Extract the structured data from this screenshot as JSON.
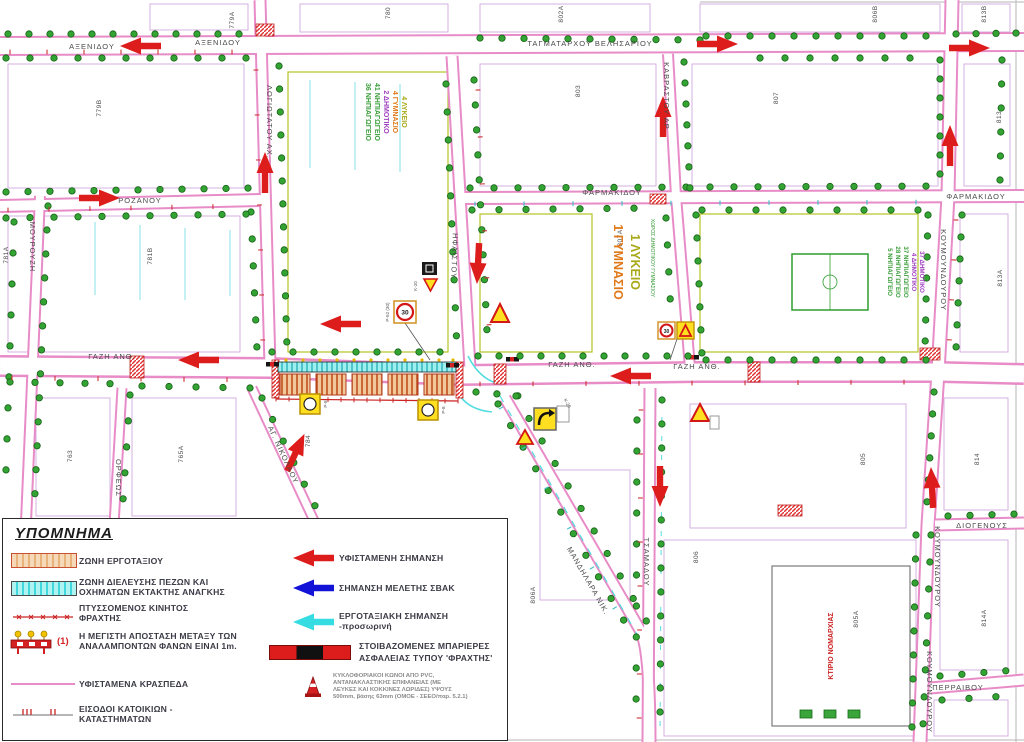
{
  "legend": {
    "title": "ΥΠΟΜΝΗΜΑ",
    "left": [
      {
        "lines": [
          "ΖΩΝΗ  ΕΡΓΟΤΑΞΙΟΥ"
        ]
      },
      {
        "lines": [
          "ΖΩΝΗ  ΔΙΕΛΕΥΣΗΣ ΠΕΖΩΝ ΚΑΙ",
          "ΟΧΗΜΑΤΩΝ ΕΚΤΑΚΤΗΣ ΑΝΑΓΚΗΣ"
        ]
      },
      {
        "lines": [
          "ΠΤΥΣΣΟΜΕΝΟΣ ΚΙΝΗΤΟΣ",
          "ΦΡΑΧΤΗΣ"
        ]
      },
      {
        "prefix": "(1)",
        "lines": [
          "Η ΜΕΓΙΣΤΗ ΑΠΟΣΤΑΣΗ ΜΕΤΑΞΥ ΤΩΝ",
          "ΑΝΑΛΑΜΠΟΝΤΩΝ ΦΑΝΩΝ ΕΙΝΑΙ 1m."
        ]
      },
      {
        "lines": [
          "ΥΦΙΣΤΑΜΕΝΑ ΚΡΑΣΠΕΔΑ"
        ]
      },
      {
        "lines": [
          "ΕΙΣΟΔΟΙ ΚΑΤΟΙΚΙΩΝ -",
          "ΚΑΤΑΣΤΗΜΑΤΩΝ"
        ]
      }
    ],
    "right": [
      {
        "lines": [
          "ΥΦΙΣΤΑΜΕΝΗ ΣΗΜΑΝΣΗ"
        ]
      },
      {
        "lines": [
          "ΣΗΜΑΝΣΗ ΜΕΛΕΤΗΣ ΣΒΑΚ"
        ]
      },
      {
        "lines": [
          "ΕΡΓΟΤΑΞΙΑΚΗ ΣΗΜΑΝΣΗ",
          "-προσωρινή"
        ]
      },
      {
        "lines": [
          "ΣΤΟΙΒΑΖΟΜΕΝΕΣ ΜΠΑΡΙΕΡΕΣ",
          "ΑΣΦΑΛΕΙΑΣ ΤΥΠΟΥ 'ΦΡΑΧΤΗΣ'"
        ]
      },
      {
        "lines": [
          "ΚΥΚΛΟΦΟΡΙΑΚΟΙ ΚΩΝΟΙ ΑΠΟ PVC,",
          "ΑΝΤΑΝΑΚΛΑΣΤΙΚΗΣ ΕΠΙΦΑΝΕΙΑΣ (ΜΕ",
          "ΛΕΥΚΕΣ ΚΑΙ ΚΟΚΚΙΝΕΣ ΛΩΡΙΔΕΣ) ΥΨΟΥΣ",
          "500mm, βάσης 63mm (ΟΜΟΕ - ΣΕΕΟ/παρ. 5.2.1)"
        ]
      }
    ]
  },
  "map": {
    "streets": {
      "axenidou": "ΑΞΕΝΙΔΟΥ",
      "tagmatarchou": "ΤΑΓΜΑΤΑΡΧΟΥ ΒΕΛΗΣΑΡΙΟΥ",
      "logiotatou": "ΛΟΓΙΩΤΑΤΟΥ ΑΧ.",
      "mourouzi": "ΜΟΥΡΟΥΖΗ",
      "rozanou": "ΡΟΖΑΝΟΥ",
      "farmakidou": "ΦΑΡΜΑΚΙΔΟΥ",
      "kavrastou": "ΚΑΒΡΑΣΤΟΥ ΑΡ.",
      "gazi": "ΓΑΖΗ ΑΝΘ.",
      "ifaistou": "ΗΦΑΙΣΤΟΥ",
      "tsamadou": "ΤΣΑΜΑΔΟΥ",
      "mandilara": "ΜΑΝΔΗΛΑΡΑ ΝΙΚ.",
      "ag_nikolaou": "ΑΓ. ΝΙΚΟΛΑΟΥ",
      "orfeos": "ΟΡΦΕΩΣ",
      "koumoundourou": "ΚΟΥΜΟΥΝΔΟΥΡΟΥ",
      "diogenous": "ΔΙΟΓΕΝΟΥΣ",
      "perraivou": "ΠΕΡΡΑΙΒΟΥ",
      "xoros_dimotikou": "ΧΩΡΟΣ ΔΗΜΟΤΙΚΟΥ ΓΥΜΝΑΣΙΟΥ",
      "ktirio_nomarchias": "ΚΤΙΡΙΟ ΝΟΜΑΡΧΙΑΣ"
    },
    "blocks": [
      "779A",
      "779B",
      "781A",
      "781B",
      "780",
      "802A",
      "803",
      "807A",
      "807",
      "806B",
      "813B",
      "813",
      "813A",
      "763",
      "765A",
      "784",
      "805",
      "805A",
      "806",
      "806A",
      "814",
      "814A"
    ],
    "schools_left": [
      {
        "text": "36 ΝΗΠΙΑΓΩΓΕΙΟ",
        "color": "#3c9e3c"
      },
      {
        "text": "41 ΝΗΠΙΑΓΩΓΕΙΟ",
        "color": "#3c9e3c"
      },
      {
        "text": "2 ΔΗΜΟΤΙΚΟ",
        "color": "#a040c0"
      },
      {
        "text": "4 ΓΥΜΝΑΣΙΟ",
        "color": "#e07818"
      },
      {
        "text": "4 ΛΥΚΕΙΟ",
        "color": "#a8a818"
      }
    ],
    "schools_center": [
      {
        "text": "1 ΓΥΜΝΑΣΙΟ",
        "color": "#e07818"
      },
      {
        "text": "1 ΛΥΚΕΙΟ",
        "color": "#a8a818"
      }
    ],
    "schools_right": [
      {
        "text": "5 ΝΗΠΙΑΓΩΓΕΙΟ",
        "color": "#3c9e3c"
      },
      {
        "text": "28 ΝΗΠΙΑΓΩΓΕΙΟ",
        "color": "#3c9e3c"
      },
      {
        "text": "37 ΝΗΠΙΑΓΩΓΕΙΟ",
        "color": "#3c9e3c"
      },
      {
        "text": "4 ΔΗΜΟΤΙΚΟ",
        "color": "#a040c0"
      },
      {
        "text": "37 ΔΗΜΟΤΙΚΟ",
        "color": "#a040c0"
      }
    ],
    "signs": {
      "p8": "Ρ-8",
      "p52": "Ρ-52 (30)",
      "k20": "Κ-20",
      "speed": "30"
    }
  },
  "colors": {
    "existing_signage_red": "#dd1c1c",
    "svak_blue": "#1313d8",
    "worksite_cyan": "#35dde2",
    "work_zone_orange": "#e8a25a",
    "sign_yellow": "#ffdf20",
    "tree_green": "#33a433",
    "curb_pink": "#e88cc8"
  }
}
